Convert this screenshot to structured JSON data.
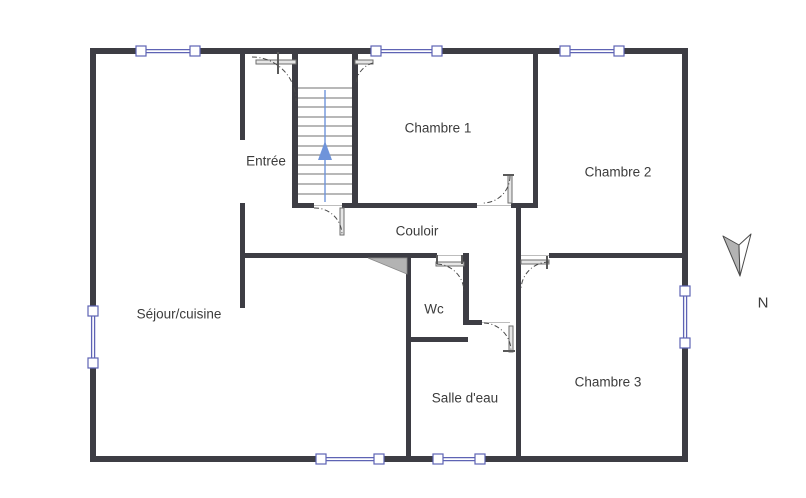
{
  "floorplan": {
    "rooms": {
      "entree": "Entrée",
      "chambre1": "Chambre 1",
      "chambre2": "Chambre 2",
      "couloir": "Couloir",
      "sejour_cuisine": "Séjour/cuisine",
      "wc": "Wc",
      "salle_deau": "Salle d'eau",
      "chambre3": "Chambre 3"
    },
    "compass": {
      "north_label": "N"
    },
    "colors": {
      "bg": "#ffffff",
      "wall": "#3d3d44",
      "win": "#5e63b4",
      "arrow": "#6f94da",
      "text": "#3c3c3c",
      "thin": "#707070",
      "leaf": "#e6e6e6",
      "leafstroke": "#6e6e6e",
      "tri": "#b3b3b3"
    }
  }
}
